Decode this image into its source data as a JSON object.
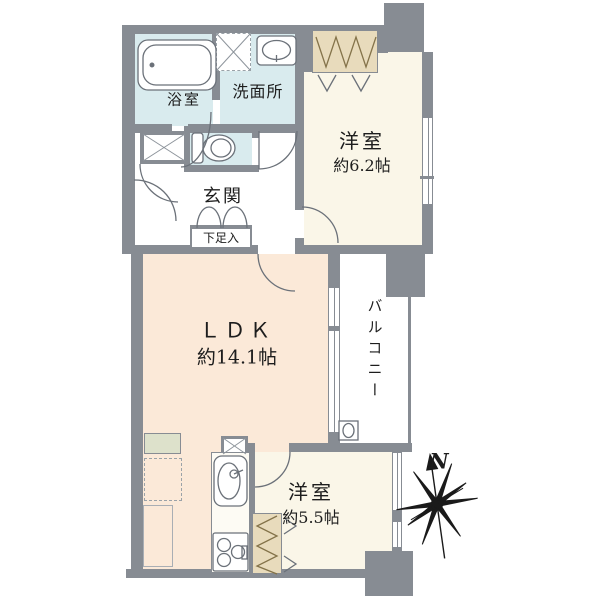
{
  "rooms": {
    "bathroom": {
      "name": "浴室"
    },
    "washroom": {
      "name": "洗面所"
    },
    "bedroom_north": {
      "name": "洋室",
      "area": "約6.2帖"
    },
    "entrance": {
      "name": "玄関"
    },
    "shoe_cabinet": {
      "name": "下足入"
    },
    "ldk": {
      "name": "ＬＤＫ",
      "area": "約14.1帖"
    },
    "balcony": {
      "name": "バルコニー"
    },
    "bedroom_south": {
      "name": "洋室",
      "area": "約5.5帖"
    }
  },
  "compass": {
    "north_label": "N"
  },
  "colors": {
    "wall": "#878c93",
    "water_room": "#d9ebee",
    "room": "#faf6e8",
    "ldk": "#fbe9d8",
    "closet": "#e8dbbc",
    "counter": "#dde1cb",
    "outline": "#6b7179",
    "background": "#ffffff"
  }
}
